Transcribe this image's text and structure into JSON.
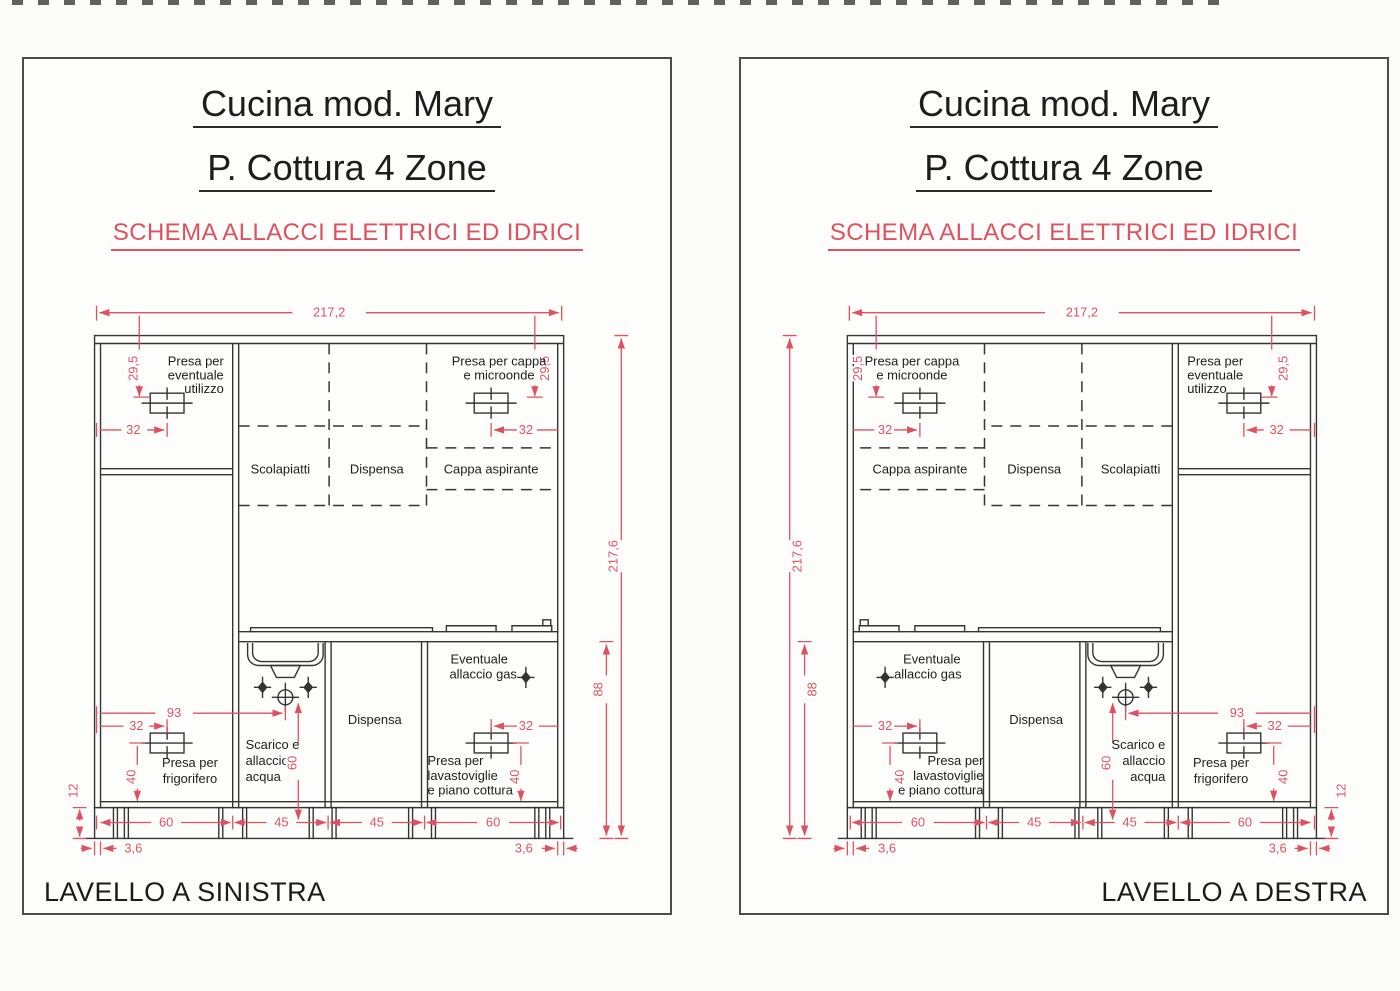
{
  "colors": {
    "dimension_red": "#e0515f",
    "ink": "#343434",
    "heading_ink": "#1d1d1d"
  },
  "panels": [
    {
      "title_line1": "Cucina mod. Mary",
      "title_line2": "P. Cottura 4 Zone",
      "subtitle": "SCHEMA ALLACCI ELETTRICI ED IDRICI",
      "footer": "LAVELLO A SINISTRA",
      "labels": {
        "presa_eventuale": [
          "Presa per",
          "eventuale",
          "utilizzo"
        ],
        "presa_cappa": [
          "Presa per cappa",
          "e microonde"
        ],
        "scolapiatti": "Scolapiatti",
        "dispensa_top": "Dispensa",
        "cappa": "Cappa aspirante",
        "gas": [
          "Eventuale",
          "allaccio gas"
        ],
        "scarico": [
          "Scarico e",
          "allaccio",
          "acqua"
        ],
        "dispensa_base": "Dispensa",
        "presa_lavastoviglie": [
          "Presa per",
          "lavastoviglie",
          "e piano cottura"
        ],
        "presa_frigo": [
          "Presa per",
          "frigorifero"
        ]
      },
      "dims": {
        "top_width": "217,2",
        "height_total": "217,6",
        "height_base": "88",
        "h295_left": "29,5",
        "h295_right": "29,5",
        "d32_tl": "32",
        "d32_tr": "32",
        "d32_bl": "32",
        "d32_br": "32",
        "d93": "93",
        "d60_drain": "60",
        "d40_left": "40",
        "d40_right": "40",
        "d12": "12",
        "bottom": [
          "60",
          "45",
          "45",
          "60"
        ],
        "d36_left": "3,6",
        "d36_right": "3,6"
      }
    },
    {
      "title_line1": "Cucina mod. Mary",
      "title_line2": "P. Cottura 4 Zone",
      "subtitle": "SCHEMA ALLACCI ELETTRICI ED IDRICI",
      "footer": "LAVELLO A DESTRA",
      "labels": {
        "presa_eventuale": [
          "Presa per",
          "eventuale",
          "utilizzo"
        ],
        "presa_cappa": [
          "Presa per cappa",
          "e microonde"
        ],
        "scolapiatti": "Scolapiatti",
        "dispensa_top": "Dispensa",
        "cappa": "Cappa aspirante",
        "gas": [
          "Eventuale",
          "allaccio gas"
        ],
        "scarico": [
          "Scarico e",
          "allaccio",
          "acqua"
        ],
        "dispensa_base": "Dispensa",
        "presa_lavastoviglie": [
          "Presa per",
          "lavastoviglie",
          "e piano cottura"
        ],
        "presa_frigo": [
          "Presa per",
          "frigorifero"
        ]
      },
      "dims": {
        "top_width": "217,2",
        "height_total": "217,6",
        "height_base": "88",
        "h295_left": "29,5",
        "h295_right": "29,5",
        "d32_tl": "32",
        "d32_tr": "32",
        "d32_bl": "32",
        "d32_br": "32",
        "d93": "93",
        "d60_drain": "60",
        "d40_left": "40",
        "d40_right": "40",
        "d12": "12",
        "bottom": [
          "60",
          "45",
          "45",
          "60"
        ],
        "d36_left": "3,6",
        "d36_right": "3,6"
      }
    }
  ]
}
